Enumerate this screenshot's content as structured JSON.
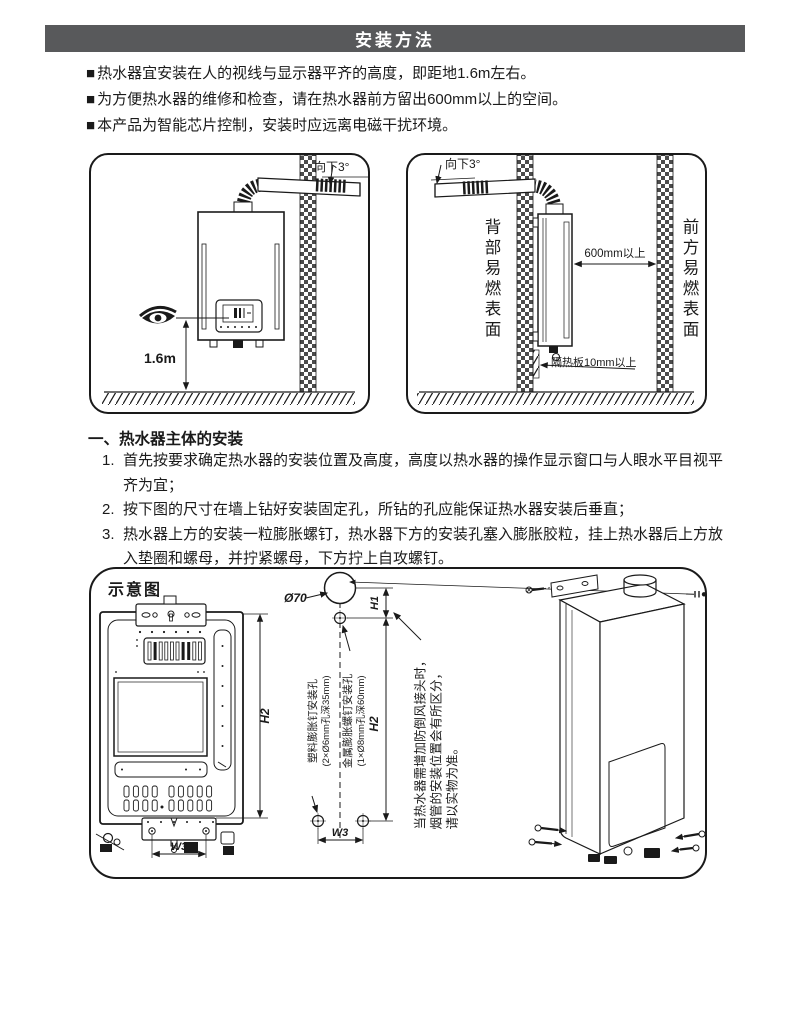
{
  "header": {
    "title": "安装方法"
  },
  "bullets": {
    "marker": "■",
    "items": [
      "热水器宜安装在人的视线与显示器平齐的高度，即距地1.6m左右。",
      "为方便热水器的维修和检查，请在热水器前方留出600mm以上的空间。",
      "本产品为智能芯片控制，安装时应远离电磁干扰环境。"
    ]
  },
  "diagram_eye_level": {
    "tilt_label": "向下3°",
    "eye_height": "1.6m"
  },
  "diagram_clearance": {
    "tilt_label": "向下3°",
    "rear_surface": "背部易燃表面",
    "front_surface": "前方易燃表面",
    "front_clearance": "600mm以上",
    "insulation": "隔热板10mm以上"
  },
  "section": {
    "title": "一、热水器主体的安装",
    "steps": [
      {
        "num": "1.",
        "text": "首先按要求确定热水器的安装位置及高度，高度以热水器的操作显示窗口与人眼水平目视平齐为宜；"
      },
      {
        "num": "2.",
        "text": "按下图的尺寸在墙上钻好安装固定孔，所钻的孔应能保证热水器安装后垂直；"
      },
      {
        "num": "3.",
        "text": "热水器上方的安装一粒膨胀螺钉，热水器下方的安装孔塞入膨胀胶粒，挂上热水器后上方放入垫圈和螺母，并拧紧螺母，下方拧上自攻螺钉。"
      }
    ]
  },
  "schematic": {
    "title": "示意图",
    "flue_hole": "Ø70",
    "dim_h1": "H1",
    "dim_h2": "H2",
    "dim_w3": "W3",
    "plastic_holes_line1": "塑料膨胀钉安装孔",
    "plastic_holes_line2": "(2×Ø6mm孔深35mm)",
    "metal_hole_line1": "金属膨胀螺钉安装孔",
    "metal_hole_line2": "(1×Ø8mm孔深60mm)",
    "note_line1": "当热水器需增加防倒风接头时，",
    "note_line2": "烟管的安装位置会有所区分，",
    "note_line3": "请以实物为准。"
  }
}
